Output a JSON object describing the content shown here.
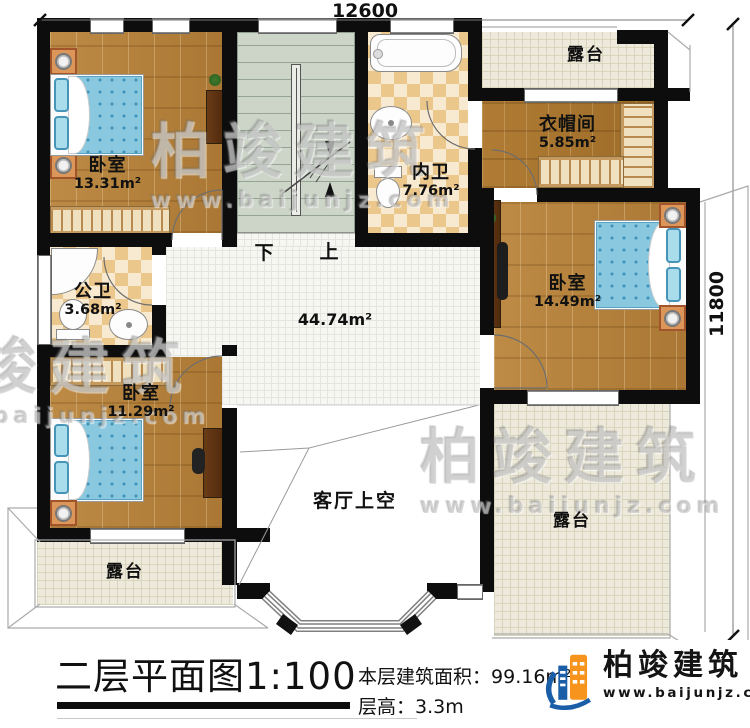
{
  "dimensions": {
    "top": "12600",
    "right": "11800"
  },
  "rooms": {
    "bedroom_tl": {
      "name": "卧室",
      "area": "13.31m²"
    },
    "bath_inner": {
      "name": "内卫",
      "area": "7.76m²"
    },
    "cloakroom": {
      "name": "衣帽间",
      "area": "5.85m²"
    },
    "bedroom_right": {
      "name": "卧室",
      "area": "14.49m²"
    },
    "bath_public": {
      "name": "公卫",
      "area": "3.68m²"
    },
    "bedroom_left": {
      "name": "卧室",
      "area": "11.29m²"
    },
    "hall_area": "44.74m²",
    "living_void": "客厅上空",
    "terrace_top": "露台",
    "terrace_bottom_left": "露台",
    "terrace_bottom_right": "露台"
  },
  "stairs": {
    "down": "下",
    "up": "上"
  },
  "title": {
    "text": "二层平面图",
    "scale": "1:100"
  },
  "info": {
    "area_label": "本层建筑面积：",
    "area_value": "99.16m²",
    "height_label": "层高：",
    "height_value": "3.3m"
  },
  "logo": {
    "name": "柏竣建筑",
    "url": "www.baijunjz.com"
  },
  "watermark": {
    "name": "柏竣建筑",
    "url": "www.baijunjz.com"
  },
  "colors": {
    "logo_blue": "#1b5ea8",
    "logo_orange": "#f7941d",
    "wall": "#0d0d0d"
  }
}
